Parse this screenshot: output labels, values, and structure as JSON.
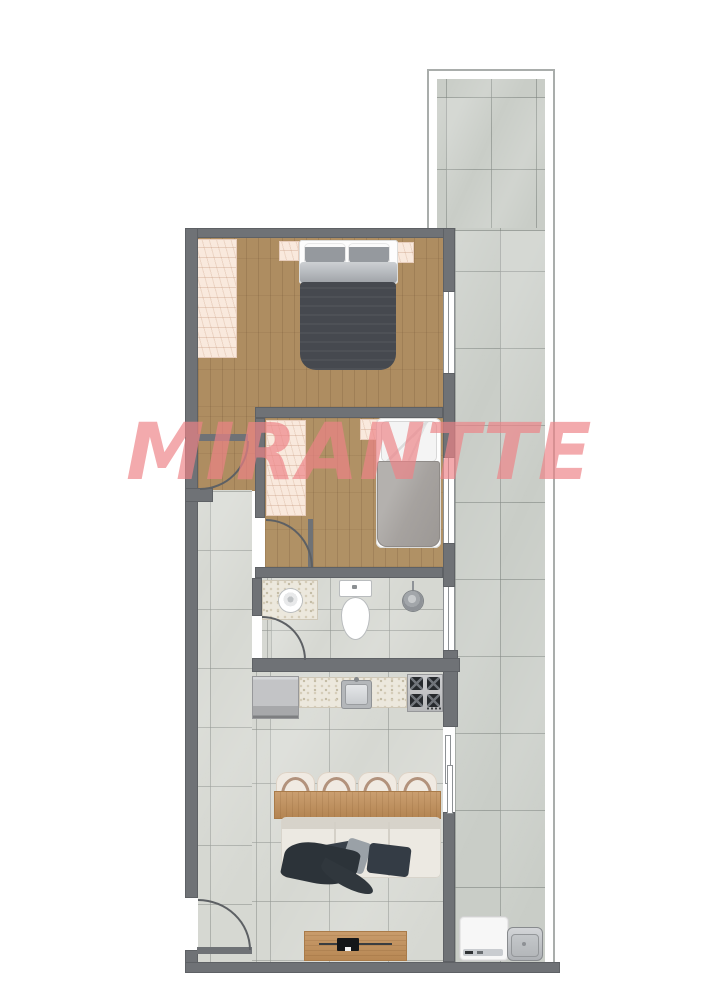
{
  "image": {
    "kind": "apartment floor plan",
    "watermark": {
      "text": "MIRANTTE",
      "color": "#ee8387"
    }
  },
  "palette": {
    "wall": "#6f7276",
    "wood_floor": "#ae8d61",
    "interior_tile": "#d6d8d2",
    "balcony_tile": "#c9cdc7",
    "wardrobe_peach": "#f9e9dd",
    "granite_counter": "#ece8dd",
    "dark_duvet": "#46494f",
    "sofa_cream": "#ece9e2",
    "table_wood": "#c28f58",
    "watermark_pink": "#ee8387"
  },
  "rooms": [
    {
      "name": "bedroom-1",
      "features": [
        "double-bed",
        "wardrobe",
        "nightstand-left",
        "nightstand-right",
        "window"
      ]
    },
    {
      "name": "bedroom-2",
      "features": [
        "single-bed",
        "wardrobe",
        "nightstand",
        "window"
      ]
    },
    {
      "name": "bathroom",
      "features": [
        "vanity-sink",
        "toilet",
        "shower",
        "window"
      ]
    },
    {
      "name": "kitchen",
      "features": [
        "fridge",
        "counter-sink",
        "stove"
      ]
    },
    {
      "name": "living-dining",
      "features": [
        "dining-table",
        "four-chairs",
        "sofa",
        "tv-stand",
        "entry-door"
      ]
    },
    {
      "name": "balcony-terrace",
      "features": [
        "tiled-floor",
        "washing-machine",
        "laundry-tank",
        "sliding-door"
      ]
    }
  ]
}
